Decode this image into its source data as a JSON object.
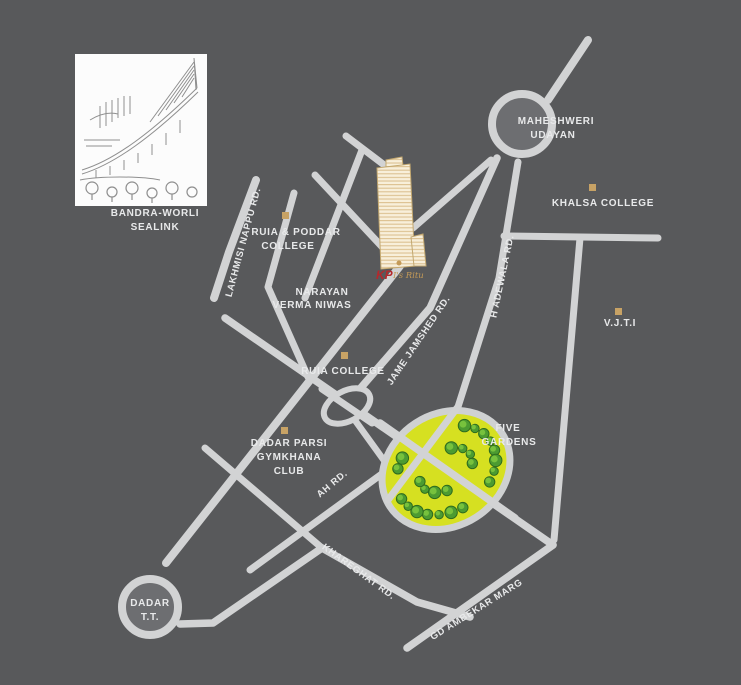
{
  "colors": {
    "background": "#58595b",
    "road": "#d2d3d4",
    "label": "#e8e9ea",
    "marker": "#c7a265",
    "circle_inner": "#6d6e71",
    "garden_fill": "#d6e021",
    "garden_ring": "#cfd1d2",
    "tree_dark": "#2e6b1e",
    "tree_mid": "#4c9b31",
    "tree_light": "#7cc63f",
    "building_fill": "#f8efda",
    "building_stripe": "#dcc191",
    "building_outline": "#c3a870",
    "logo_red": "#b5282c",
    "logo_gold": "#c49a57",
    "inset_bg": "#fcfcfc",
    "sketch_stroke": "#8f8f8f"
  },
  "inset": {
    "caption_line1": "BANDRA-WORLI",
    "caption_line2": "SEALINK"
  },
  "junctions": {
    "maheshweri": {
      "line1": "MAHESHWERI",
      "line2": "UDAYAN"
    },
    "dadar_tt": {
      "line1": "DADAR",
      "line2": "T.T."
    }
  },
  "landmarks": {
    "ruia_poddar": {
      "line1": "RUIA & PODDAR",
      "line2": "COLLEGE"
    },
    "narayan": {
      "line1": "NARAYAN",
      "line2": "VERMA NIWAS"
    },
    "khalsa": {
      "label": "KHALSA COLLEGE"
    },
    "vjti": {
      "label": "V.J.T.I"
    },
    "ruia_college": {
      "label": "RUIA COLLEGE"
    },
    "dadar_parsi": {
      "line1": "DADAR PARSI",
      "line2": "GYMKHANA",
      "line3": "CLUB"
    },
    "five_gardens": {
      "line1": "FIVE",
      "line2": "GARDENS"
    }
  },
  "roads": {
    "lakhmisi": "LAKHMISI NAPPU RD.",
    "jame_jamshed": "JAME JAMSHED RD.",
    "h_adewala": "H ADEWALA RD.",
    "ah": "AH RD.",
    "khareghat": "KHAREGHAT RD.",
    "gd_ambekar": "GD AMBEKAR MARG"
  },
  "logo": {
    "prefix": "KP",
    "script": "I's Ritu"
  }
}
